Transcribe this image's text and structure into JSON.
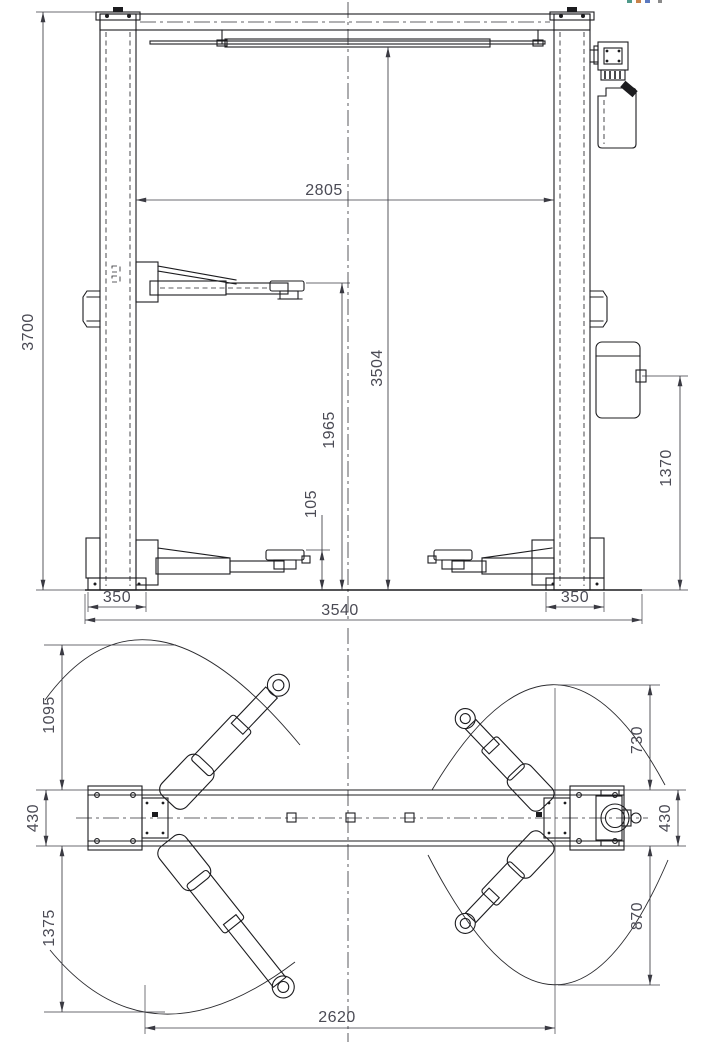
{
  "front_view": {
    "dim_inner_width": "2805",
    "dim_total_height": "3700",
    "dim_clear_height": "3504",
    "dim_pad_raised_height": "1965",
    "dim_unit_height": "1370",
    "dim_pad_lowered_height": "105",
    "dim_base_left": "350",
    "dim_overall_width": "3540",
    "dim_base_right": "350"
  },
  "plan_view": {
    "dim_front_swing_left": "1095",
    "dim_front_swing_right": "730",
    "dim_base_depth_left": "430",
    "dim_base_depth_right": "430",
    "dim_rear_swing_left": "1375",
    "dim_rear_swing_right": "870",
    "dim_drive_through": "2620"
  },
  "colors": {
    "line": "#1c1c1f",
    "dim_text": "#4b4b55",
    "bg": "#ffffff",
    "mark1": "#4f9a8a",
    "mark2": "#c8824a",
    "mark3": "#5b79c0",
    "mark4": "#8a8a8a"
  }
}
